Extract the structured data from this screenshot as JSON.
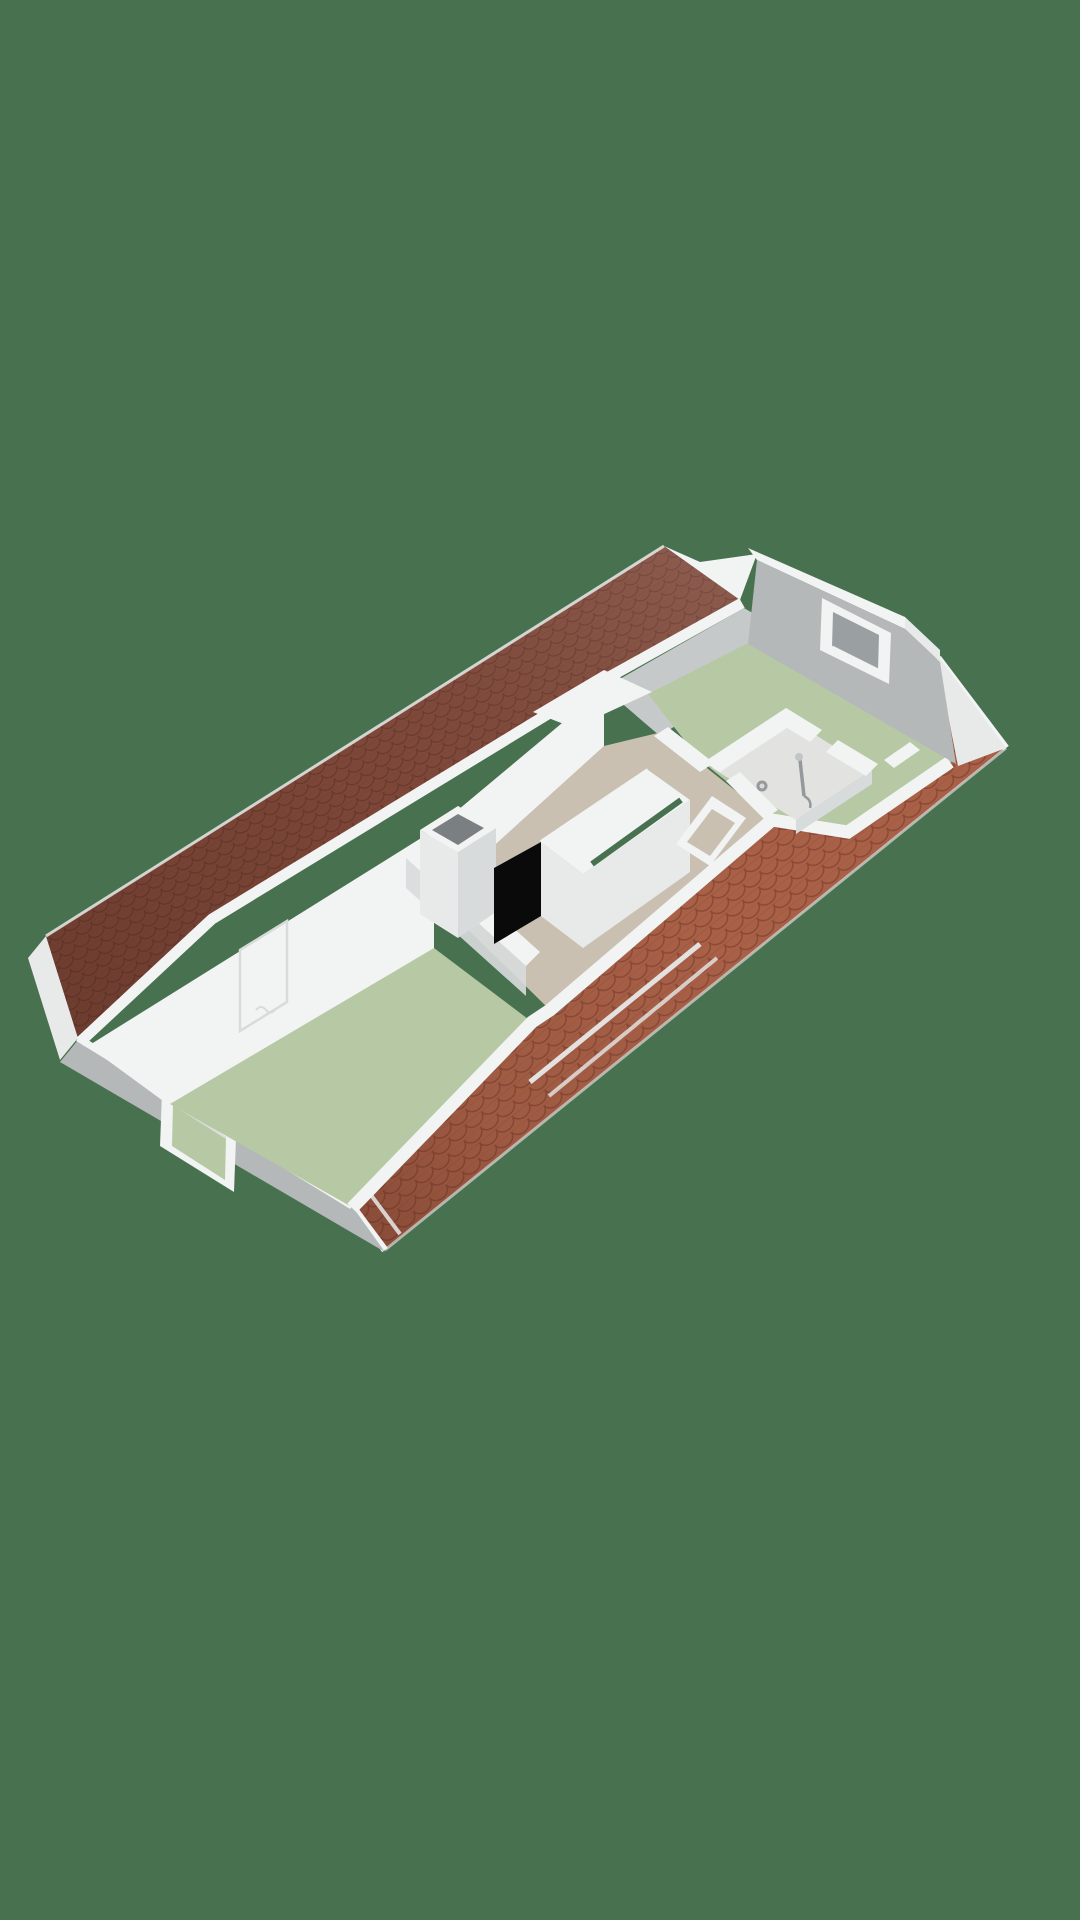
{
  "scene": {
    "kind": "3d-floorplan-render",
    "floor_label": "attic floor",
    "background": "#47714F"
  },
  "colors": {
    "background": "#47714F",
    "roof_ul_base": "#80493A",
    "roof_ul_line": "#6B3A2D",
    "roof_lr_base": "#A86047",
    "roof_lr_line": "#8A4936",
    "roof_shadow": "#4A241A",
    "wall_white": "#F2F3F3",
    "wall_soft": "#E8EAEA",
    "wall_shade": "#D8DBDB",
    "wall_gray": "#B5B8B9",
    "dormer_gray": "#C6C9CA",
    "floor_green": "#B7C8A4",
    "floor_taupe": "#C9C0B2",
    "floor_bath": "#E2E3E1",
    "stair_void": "#0A0A0A",
    "chimney_hole": "#7A7F81",
    "window_reveal": "#9AA0A2",
    "fixture_gray": "#95999B",
    "fixture_light": "#C2C5C6"
  },
  "rooms": [
    {
      "id": "bedroom-rear",
      "floor_color": "#B7C8A4"
    },
    {
      "id": "bedroom-front",
      "floor_color": "#B7C8A4"
    },
    {
      "id": "landing",
      "floor_color": "#C9C0B2"
    },
    {
      "id": "bathroom",
      "floor_color": "#E2E3E1"
    }
  ],
  "elements": [
    {
      "id": "roof-upper-left",
      "type": "roof-slope",
      "color": "#80493A"
    },
    {
      "id": "roof-lower-right",
      "type": "roof-slope",
      "color": "#A86047"
    },
    {
      "id": "chimney",
      "type": "shaft"
    },
    {
      "id": "stairwell",
      "type": "stair-opening",
      "color": "#0A0A0A"
    },
    {
      "id": "door-frame",
      "type": "doorway"
    },
    {
      "id": "window-right-gable",
      "type": "window"
    },
    {
      "id": "window-left-gable",
      "type": "window"
    },
    {
      "id": "shower",
      "type": "fixture"
    }
  ]
}
